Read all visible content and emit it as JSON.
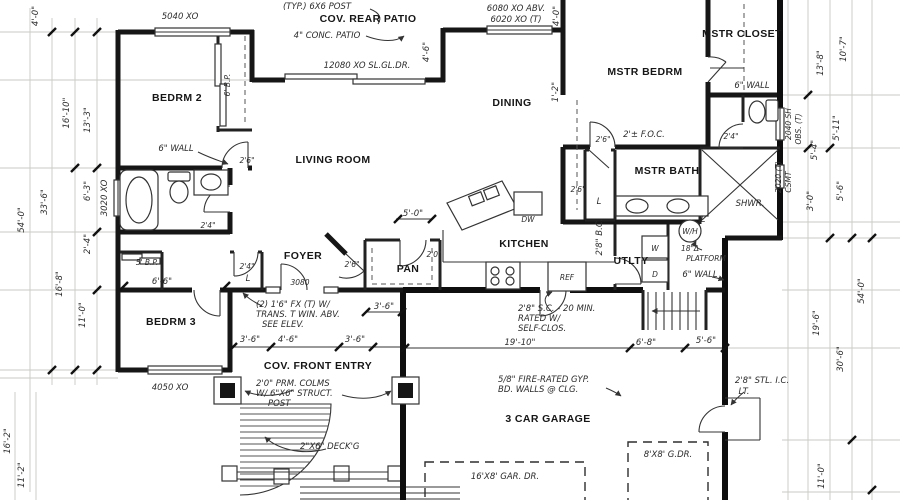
{
  "plan": {
    "rooms": {
      "bedrm2": "BEDRM 2",
      "bedrm3": "BEDRM 3",
      "living": "LIVING ROOM",
      "dining": "DINING",
      "kitchen": "KITCHEN",
      "foyer": "FOYER",
      "pantry": "PAN",
      "utility": "UTLTY",
      "mstr_bedrm": "MSTR BEDRM",
      "mstr_closet": "MSTR CLOSET",
      "mstr_bath": "MSTR BATH",
      "rear_patio": "COV. REAR PATIO",
      "front_entry": "COV. FRONT ENTRY",
      "garage": "3 CAR GARAGE"
    },
    "fixtures": {
      "dishwasher": "DW",
      "refrigerator": "REF",
      "washer": "W",
      "dryer": "D",
      "water_heater": "W/H",
      "shower": "SHWR.",
      "linen": "L"
    },
    "windows": {
      "bedrm2": "5040 XO",
      "bedrm3": "4050 XO",
      "bath": "3020 XO",
      "patio_slider": "12080 XO SL.GL.DR.",
      "dining_above": "6080 XO ABV.",
      "dining_tempered": "6020 XO (T)",
      "mbath_line1": "2040 SH",
      "mbath_line2": "OBS. (T)",
      "shower_line1": "2020 (T)",
      "shower_line2": "CSMT"
    },
    "doors": {
      "d26": "2'6\"",
      "d24": "2'4\"",
      "d20": "2'0\"",
      "front": "3080",
      "bypass5": "5' B.P.",
      "bypass6": "6' B.P.",
      "opening28": "2'8\" B.C.",
      "steel_line1": "2'8\" STL. I.C.",
      "steel_line2": "LT."
    },
    "notes": {
      "typ_post": "(TYP.) 6X6 POST",
      "conc_patio": "4\" CONC. PATIO",
      "wall6": "6\" WALL",
      "foc": "2'± F.O.C.",
      "trans_line1": "(2) 1'6\" FX (T) W/",
      "trans_line2": "TRANS. T WIN. ABV.",
      "trans_line3": "SEE ELEV.",
      "colms_line1": "2'0\" PRM. COLMS",
      "colms_line2": "W/ 6\"X6\" STRUCT.",
      "colms_line3": "POST",
      "decking": "2\"X6\" DECK'G",
      "fire_line1": "5/8\" FIRE-RATED GYP.",
      "fire_line2": "BD. WALLS @ CLG.",
      "sc_line1": "2'8\" S.C. - 20 MIN.",
      "sc_line2": "RATED W/",
      "sc_line3": "SELF-CLOS.",
      "platform_line1": "18\"Δ",
      "platform_line2": "PLATFORM",
      "garage_door16": "16'X8' GAR. DR.",
      "garage_door8": "8'X8' G.DR."
    },
    "dims": {
      "left_4_0": "4'-0\"",
      "left_54_0": "54'-0\"",
      "left_33_6": "33'-6\"",
      "left_16_10": "16'-10\"",
      "left_13_3": "13'-3\"",
      "left_6_3": "6'-3\"",
      "left_2_4": "2'-4\"",
      "left_16_8": "16'-8\"",
      "left_11_0": "11'-0\"",
      "bottom_left_16_2": "16'-2\"",
      "bottom_left_11_2": "11'-2\"",
      "right_13_8": "13'-8\"",
      "right_10_7": "10'-7\"",
      "right_5_11": "5'-11\"",
      "right_5_4": "5'-4\"",
      "right_5_6": "5'-6\"",
      "right_3_0": "3'-0\"",
      "right_54_0": "54'-0\"",
      "right_30_6": "30'-6\"",
      "right_19_6": "19'-6\"",
      "right_11_0": "11'-0\"",
      "patio_4_6": "4'-6\"",
      "dining_4_0": "4'-0\"",
      "dining_1_2": "1'-2\"",
      "kitchen_5_0": "5'-0\"",
      "entry_3_6": "3'-6\"",
      "entry_4_6": "4'-6\"",
      "hall_6_6": "6'-6\"",
      "garage_19_10": "19'-10\"",
      "garage_6_8": "6'-8\"",
      "garage_5_6": "5'-6\""
    }
  }
}
